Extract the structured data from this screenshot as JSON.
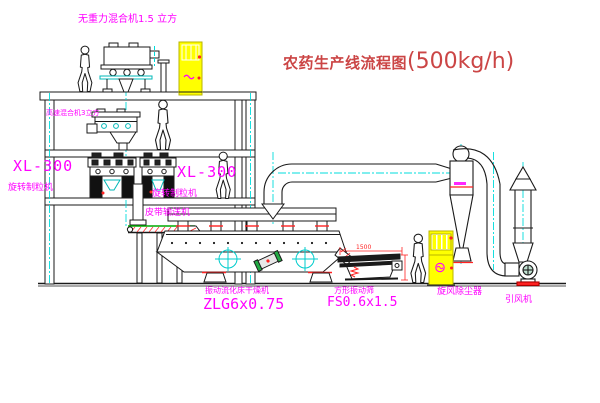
{
  "title": {
    "name": "农药生产线流程图",
    "capacity": "(500kg/h)"
  },
  "equipment_labels": {
    "top_mixer": "无重力混合机1.5 立方",
    "second_mixer": "高速混合机3立方",
    "granulator1_model": "XL-300",
    "granulator1_name": "旋转制粒机",
    "granulator2_model": "XL-300",
    "granulator2_name": "旋转制粒机",
    "belt_conveyor": "皮带输送机",
    "dryer_name": "振动流化床干燥机",
    "dryer_model": "ZLG6x0.75",
    "screen_name": "方形振动筛",
    "screen_model": "FS0.6x1.5",
    "cyclone": "旋风除尘器",
    "induced_fan": "引风机"
  },
  "dimensions": {
    "screen_width": "1500"
  },
  "colors": {
    "label_magenta": "#ff00ff",
    "title_red": "#cb4545",
    "line_black": "#1a1a1a",
    "centerline_cyan": "#00dcdc",
    "cabinet_yellow": "#ffff00",
    "accent_red": "#ff2222",
    "belt_green": "#00aa00"
  }
}
